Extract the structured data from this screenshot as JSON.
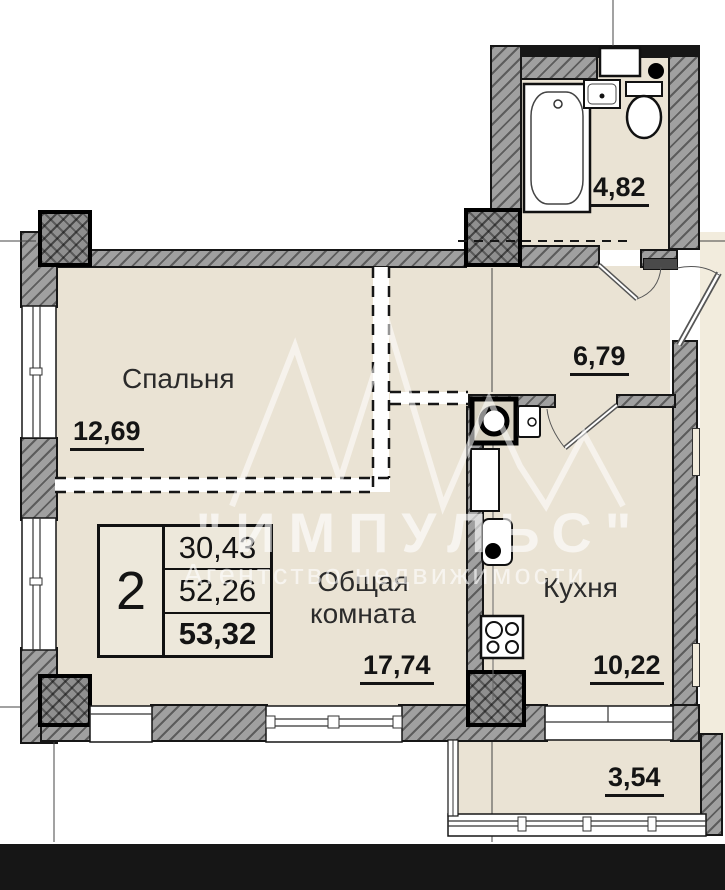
{
  "watermark": {
    "brand": "\"ИМПУЛЬС\"",
    "tagline": "Агентство недвижимости"
  },
  "rooms": {
    "bedroom": {
      "name": "Спальня",
      "area": "12,69"
    },
    "living_room": {
      "name": "Общая комната",
      "area": "17,74"
    },
    "kitchen": {
      "name": "Кухня",
      "area": "10,22"
    },
    "hallway": {
      "area": "6,79"
    },
    "bathroom": {
      "area": "4,82"
    },
    "balcony": {
      "area": "3,54"
    }
  },
  "summary_table": {
    "rooms_count": "2",
    "living_area": "30,43",
    "area_no_balcony": "52,26",
    "total_area": "53,32"
  },
  "colors": {
    "room_fill": "#eae3d4",
    "wall_gray": "#9e9e9e",
    "line_black": "#141414",
    "watermark_white": "#ffffff"
  }
}
